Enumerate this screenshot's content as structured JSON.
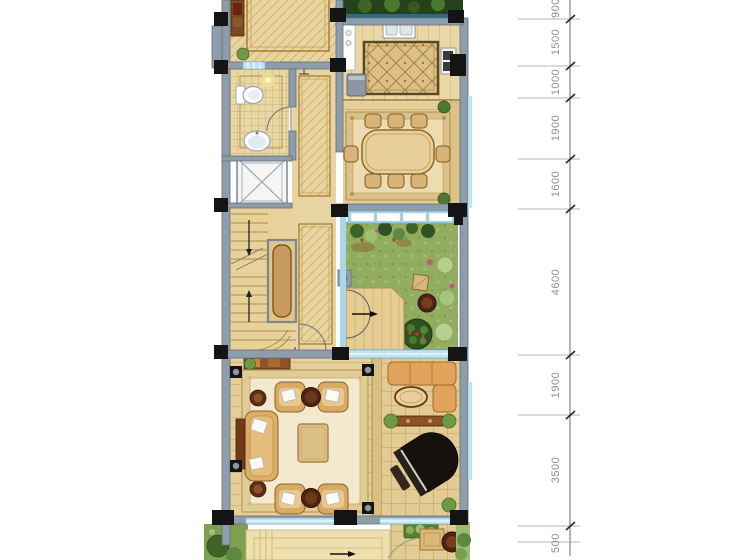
{
  "figure": {
    "type": "residential-floor-plan-rendering"
  },
  "rooms": [
    "entrance-hall",
    "bathroom",
    "elevator",
    "staircase",
    "corridor",
    "kitchen",
    "dining-room",
    "courtyard-garden",
    "living-room",
    "piano-room",
    "terrace"
  ],
  "dimension_ruler": {
    "orientation": "vertical",
    "unit": "mm",
    "labels": [
      "900",
      "1500",
      "1000",
      "1900",
      "1600",
      "4600",
      "1900",
      "3500",
      "500"
    ]
  },
  "colors": {
    "wall": "#8e9dac",
    "column": "#141414",
    "window_glass": "#bfe3f0",
    "floor_tan": "#e6d2a0",
    "floor_border": "#a87f34",
    "carpet_cream": "#f2e9cf",
    "carpet_gold": "#bd9a54",
    "grass": "#92ad60",
    "foliage_dark": "#2f5223",
    "foliage_light": "#9fbf72",
    "wood_brown": "#8a5426",
    "sofa_orange": "#e2a45c",
    "piano_black": "#16110c",
    "dimension_text": "#8f8f8f"
  }
}
